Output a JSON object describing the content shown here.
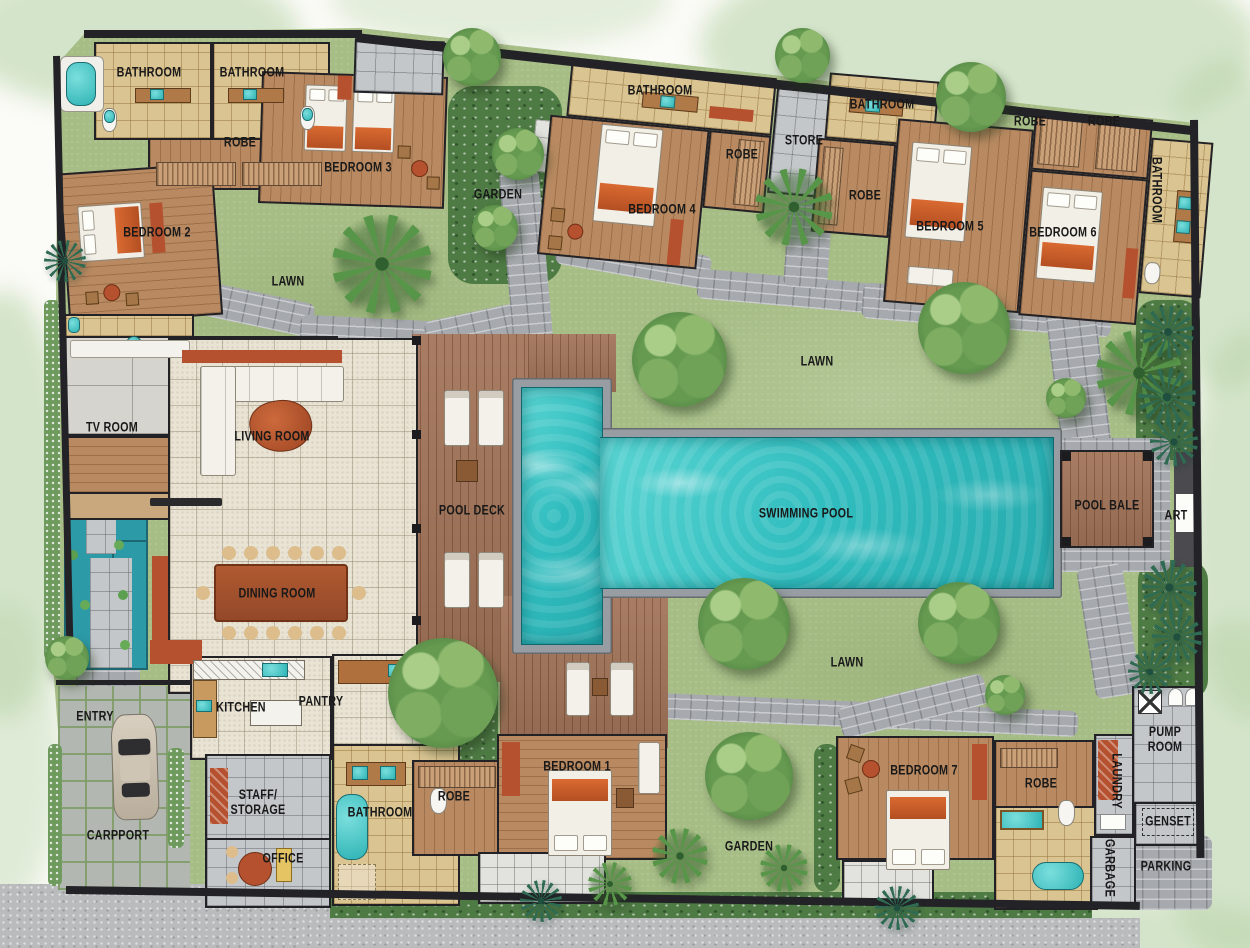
{
  "plan": {
    "type": "villa-floor-plan",
    "colors": {
      "lawn": "#a7bd86",
      "pool_water": "#3cc4c6",
      "wood_deck": "#a3755a",
      "wood_floor": "#b98a61",
      "tile_beige": "#e9e3d4",
      "tile_tan": "#d9c492",
      "tile_gray": "#c4c7ca",
      "stone_path": "#a6a9ae",
      "wall": "#232327",
      "accent_red": "#b5512e",
      "fixture_teal": "#2fb3b5",
      "pond": "#2d9aa8",
      "hedge": "#4e7a44",
      "watercolor_wash": "#bad6ac"
    },
    "labels": {
      "bathroom_bed2": "BATHROOM",
      "bathroom_bed3": "BATHROOM",
      "robe_bed23": "ROBE",
      "bedroom_3": "BEDROOM 3",
      "bedroom_2": "BEDROOM 2",
      "lawn_top_left": "LAWN",
      "garden_top": "GARDEN",
      "bathroom_bed4": "BATHROOM",
      "robe_bed4": "ROBE",
      "store": "STORE",
      "bedroom_4": "BEDROOM 4",
      "bathroom_bed5": "BATHROOM",
      "robe_bed5": "ROBE",
      "robe_bed6_left": "ROBE",
      "robe_bed6_right": "ROBE",
      "bedroom_5": "BEDROOM 5",
      "bedroom_6": "BEDROOM 6",
      "bathroom_bed6": "BATHROOM",
      "lawn_center": "LAWN",
      "lawn_east": "LAWN",
      "tv_room": "TV ROOM",
      "living_room": "LIVING ROOM",
      "dining_room": "DINING ROOM",
      "pool_deck": "POOL DECK",
      "swimming_pool": "SWIMMING POOL",
      "pool_bale": "POOL BALE",
      "art": "ART",
      "entry": "ENTRY",
      "kitchen": "KITCHEN",
      "pantry": "PANTRY",
      "staff_storage": "STAFF/\nSTORAGE",
      "carpport": "CARPPORT",
      "office": "OFFICE",
      "bathroom_bed1": "BATHROOM",
      "robe_bed1": "ROBE",
      "bedroom_1": "BEDROOM 1",
      "garden_south": "GARDEN",
      "bedroom_7": "BEDROOM 7",
      "robe_bed7": "ROBE",
      "laundry": "LAUNDRY",
      "pump_room": "PUMP\nROOM",
      "genset": "GENSET",
      "garbage": "GARBAGE",
      "parking": "PARKING"
    }
  }
}
